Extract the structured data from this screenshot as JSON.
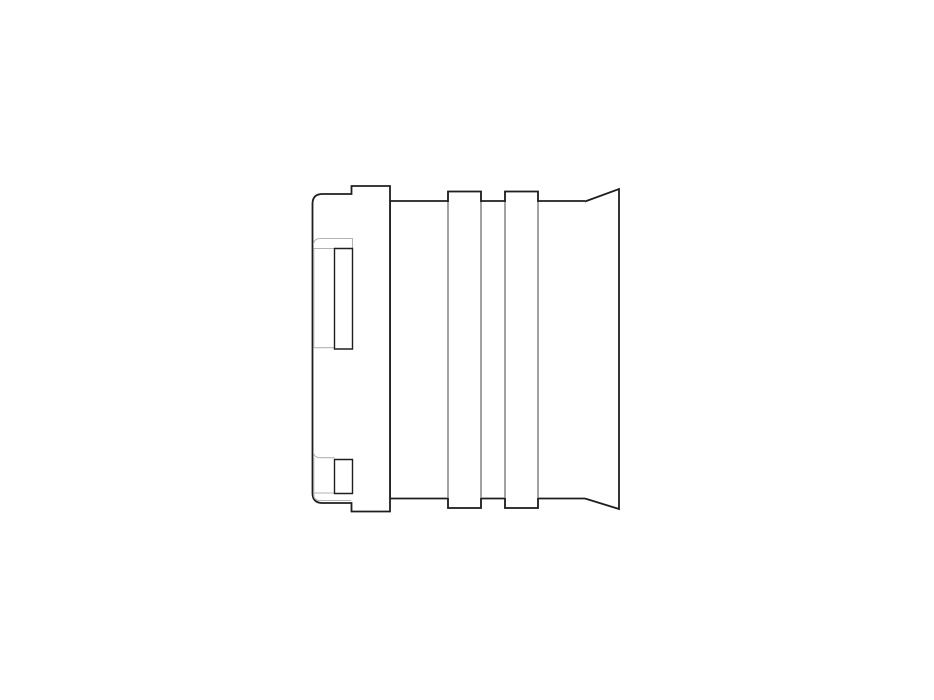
{
  "page": {
    "title": "Technical line drawing - tube fitting, side view",
    "canvas": {
      "width": 934,
      "height": 700,
      "viewBox": "0 0 934 700",
      "background": "#ffffff"
    }
  },
  "style": {
    "outline": "#1e1e1e",
    "secondary": "#707070",
    "tangent": "#b3b3b3",
    "fill": "#ffffff",
    "outline_width": 1.8,
    "detail_width": 1.4,
    "secondary_width": 1.3,
    "tangent_width": 1.1
  },
  "drawing": {
    "description": "Side elevation of a cylindrical push-fit connector: rounded housing with two latch windows at left, stepped tabs, ribbed barrel in the middle, flared bell mouth at right",
    "parts": [
      {
        "name": "bell-mouth",
        "d": "M585,201.5 L619,189 L619,509 L585,498.5",
        "stroke": "outline",
        "width": "outline_width",
        "fill": "fill"
      },
      {
        "name": "barrel",
        "d": "M585,201 L390,201 L390,498.5 L585,498.5",
        "stroke": "outline",
        "width": "outline_width",
        "fill": "fill"
      },
      {
        "name": "housing",
        "d": "M322.5,194 L351.5,194 L351.5,186 L390,186 L390,511.5 L351.5,511.5 L351.5,503 L322.5,503 Q312.5,503 312.5,493 L312.5,204 Q312.5,194 322.5,194 Z",
        "stroke": "outline",
        "width": "outline_width",
        "fill": "fill"
      },
      {
        "name": "upper-window-fillet",
        "d": "M313.5,244.5 Q313.8,238.5 320.5,238.5 L352.5,238.5 L352.5,248.5 M313.8,248.5 L334.5,248.5 M313.8,248.5 L313.8,347.7 L334.5,347.7",
        "stroke": "tangent",
        "width": "tangent_width",
        "fill": "none"
      },
      {
        "name": "upper-latch-window",
        "d": "M334.5,248.5 L352.5,248.5 L352.5,349 L334.5,349 Z",
        "stroke": "outline",
        "width": "detail_width",
        "fill": "fill"
      },
      {
        "name": "lower-window-fillet",
        "d": "M313.5,452.5 Q313.8,457.7 320.5,457.7 L334.5,457.7 M313.8,457.7 L313.8,493 L334.5,493",
        "stroke": "tangent",
        "width": "tangent_width",
        "fill": "none"
      },
      {
        "name": "lower-latch-window",
        "d": "M334.5,459.5 L352.5,459.5 L352.5,493.5 L334.5,493.5 Z",
        "stroke": "outline",
        "width": "detail_width",
        "fill": "fill"
      },
      {
        "name": "base-fillet",
        "d": "M313.8,493 L313.8,494.5 Q313.8,500.5 320,500.5 L351,500.5",
        "stroke": "tangent",
        "width": "tangent_width",
        "fill": "none"
      },
      {
        "name": "rib-1",
        "d": "M448,191.5 L481,191.5 L481,508 L448,508 Z",
        "stroke": "secondary",
        "width": "secondary_width",
        "fill": "fill"
      },
      {
        "name": "rib-1-caps",
        "d": "M448,202 L448,191.5 L481,191.5 L481,202 M448,498 L448,508 L481,508 L481,498",
        "stroke": "outline",
        "width": "outline_width",
        "fill": "none"
      },
      {
        "name": "rib-2",
        "d": "M505,191.5 L538,191.5 L538,508 L505,508 Z",
        "stroke": "secondary",
        "width": "secondary_width",
        "fill": "fill"
      },
      {
        "name": "rib-2-caps",
        "d": "M505,202 L505,191.5 L538,191.5 L538,202 M505,498 L505,508 L538,508 L538,498",
        "stroke": "outline",
        "width": "outline_width",
        "fill": "none"
      }
    ]
  }
}
